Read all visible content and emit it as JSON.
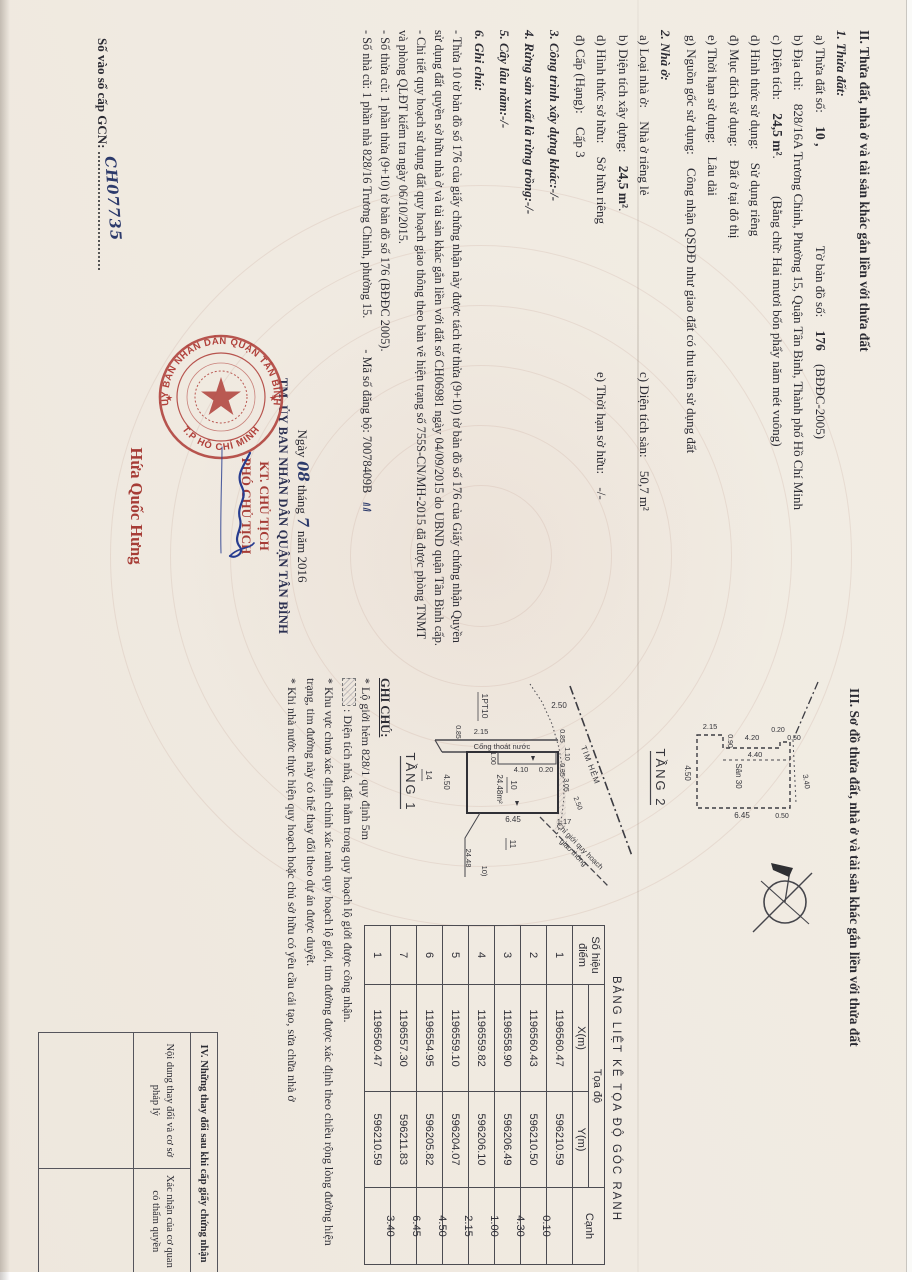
{
  "sec2": {
    "title": "II. Thửa đất, nhà ở và tài sản khác gắn liền với thửa đất",
    "p1": {
      "h": "1. Thửa đất:",
      "a_l": "a) Thửa đất số:",
      "a_v": "10 ,",
      "a_l2": "Tờ bản đồ số:",
      "a_v2": "176",
      "a_s": "(BĐĐC-2005)",
      "b_l": "b) Địa chỉ:",
      "b_v": "828/16A Trương Chinh, Phường 15, Quận Tân Bình, Thành phố Hồ Chí Minh",
      "c_l": "c) Diện tích:",
      "c_v": "24,5 m²",
      "c_dot": ".",
      "c_s": "(Bằng chữ: Hai mươi bốn phẩy năm mét vuông)",
      "d_l": "d) Hình thức sử dụng:",
      "d_v": "Sử dụng riêng",
      "dd_l": "đ) Mục đích sử dụng:",
      "dd_v": "Đất ở tại đô thị",
      "e_l": "e) Thời hạn sử dụng:",
      "e_v": "Lâu dài",
      "g_l": "g) Nguồn gốc sử dụng:",
      "g_v": "Công nhận QSDĐ như giao đất có thu tiền sử dụng đất"
    },
    "p2": {
      "h": "2. Nhà ở:",
      "a_l": "a) Loại nhà ở:",
      "a_v": "Nhà ở riêng lẻ",
      "c_l": "c) Diện tích sàn:",
      "c_v": "50,7 m²",
      "b_l": "b) Diện tích xây dựng:",
      "b_v": "24,5 m²",
      "b_dot": ".",
      "d_l": "d) Hình thức sở hữu:",
      "d_v": "Sở hữu riêng",
      "e_l": "e) Thời hạn sở hữu:",
      "e_v": "-/-",
      "dd_l": "đ) Cấp (Hạng):",
      "dd_v": "Cấp 3"
    },
    "p3": "3. Công trình xây dựng khác:-/-",
    "p4": "4. Rừng sản xuất là rừng trồng:-/-",
    "p5": "5. Cây lâu năm:-/-",
    "p6": "6. Ghi chú:",
    "notes": [
      "- Thửa 10 tờ bản đồ số 176 của giấy chứng nhận này được tách từ thửa (9+10) tờ bản đồ số 176 của Giấy chứng nhận Quyền sử dụng đất quyền sở hữu nhà ở và tài sản khác gắn liền với đất số CH06981 ngày 04/09/2015 do UBND quận Tân Bình cấp.",
      "- Chi tiết quy hoạch sử dụng đất quy hoạch giao thông theo bản vẽ hiện trạng số 755S-CN/MH-2015 đã được phòng TNMT và phòng QLĐT kiểm tra ngày 06/10/2015.",
      "- Số thửa cũ: 1 phần thửa (9+10)  tờ bản đồ số 176 (BĐĐC 2005).",
      "- Số nhà cũ: 1 phần nhà 828/16 Trương Chinh, phường 15."
    ],
    "regno_note": "- Mã số đăng bộ: 70078409B"
  },
  "sign": {
    "date_pre": "Ngày",
    "date_day": "08",
    "date_mid": "tháng",
    "date_month": "7",
    "date_post": "năm 2016",
    "tm": "TM. ỦY BAN NHÂN DÂN QUẬN TÂN BÌNH",
    "kt": "KT. CHỦ TỊCH",
    "pct": "PHÓ CHỦ TỊCH",
    "name": "Hứa Quốc Hưng",
    "seal_top": "ỦY BAN NHÂN DÂN QUẬN TÂN BÌNH",
    "seal_bottom": "T.P HỒ CHÍ MINH",
    "seal_star": "★"
  },
  "regbook": {
    "label": "Số vào sổ cấp GCN:",
    "value": "CH07735"
  },
  "sec3": {
    "title": "III. Sơ đồ thửa đất, nhà ở và tài sản khác gắn liền với thửa đất",
    "t1": {
      "name": "TẦNG 1",
      "pt": "1PT10",
      "strip": "Cống thoát nước",
      "tim": "TIM HẺM",
      "cg1": "Chỉ giới quy hoạch",
      "cg2": "giao thông",
      "area": "24.48m²",
      "plot": "10",
      "n14": "14",
      "n11": "11",
      "lead_a": "24.48",
      "lead_b": "10)",
      "d250t": "2.50",
      "d215": "2.15",
      "d085a": "0.85",
      "d100": "1.00",
      "d410": "4.10",
      "d020": "0.20",
      "d450": "4.50",
      "d645": "6.45",
      "d117": "1.17",
      "d085b": "0.85",
      "d110": "1.10",
      "d035": "0.35",
      "d305": "3.05",
      "d250b": "2.50"
    },
    "t2": {
      "name": "TẦNG 2",
      "san": "Sân 30",
      "d215": "2.15",
      "d090": "0.90",
      "d420": "4.20",
      "d440": "4.40",
      "d020": "0.20",
      "d050a": "0.50",
      "d450": "4.50",
      "d340": "3.40",
      "d645": "6.45",
      "d050b": "0.50"
    }
  },
  "coords": {
    "title": "BẢNG LIỆT KÊ TỌA ĐỘ GÓC RANH",
    "col_point_1": "Số hiệu",
    "col_point_2": "điểm",
    "col_coord": "Tọa độ",
    "col_x": "X(m)",
    "col_y": "Y(m)",
    "col_edge": "Cạnh",
    "points": [
      [
        "1",
        "1196560.47",
        "596210.59"
      ],
      [
        "2",
        "1196560.43",
        "596210.50"
      ],
      [
        "3",
        "1196558.90",
        "596206.49"
      ],
      [
        "4",
        "1196559.82",
        "596206.10"
      ],
      [
        "5",
        "1196559.10",
        "596204.07"
      ],
      [
        "6",
        "1196554.95",
        "596205.82"
      ],
      [
        "7",
        "1196557.30",
        "596211.83"
      ],
      [
        "1",
        "1196560.47",
        "596210.59"
      ]
    ],
    "edges": [
      "0.10",
      "4.30",
      "1.00",
      "2.15",
      "4.50",
      "6.45",
      "3.40"
    ]
  },
  "ghichu": {
    "title": "GHI CHÚ:",
    "line1": "* Lộ giới hẻm 828/1 quy định 5m",
    "legend": ": Diện tích nhà, đất nằm trong quy hoạch lộ giới được công nhận.",
    "b1": "* Khu vực chưa xác định chính xác ranh quy hoạch lộ giới, tim đường được xác định theo chiều rộng lòng đường hiện trạng, tim đường này có thể thay đổi theo dự án được duyệt.",
    "b2": "* Khi nhà nước thực hiện quy hoạch hoặc chủ sở hữu có yêu cầu cải tạo, sửa chữa nhà ở"
  },
  "sec4": {
    "title": "IV. Những thay đổi sau khi cấp giấy chứng nhận",
    "col1": "Nội dung thay đổi và cơ sở pháp lý",
    "col2": "Xác nhận của cơ quan có thẩm quyền"
  },
  "colors": {
    "red": "#a63c36",
    "seal": "#b0403a",
    "ink_blue": "#2c3a6b",
    "paper": "#f1ece3"
  }
}
